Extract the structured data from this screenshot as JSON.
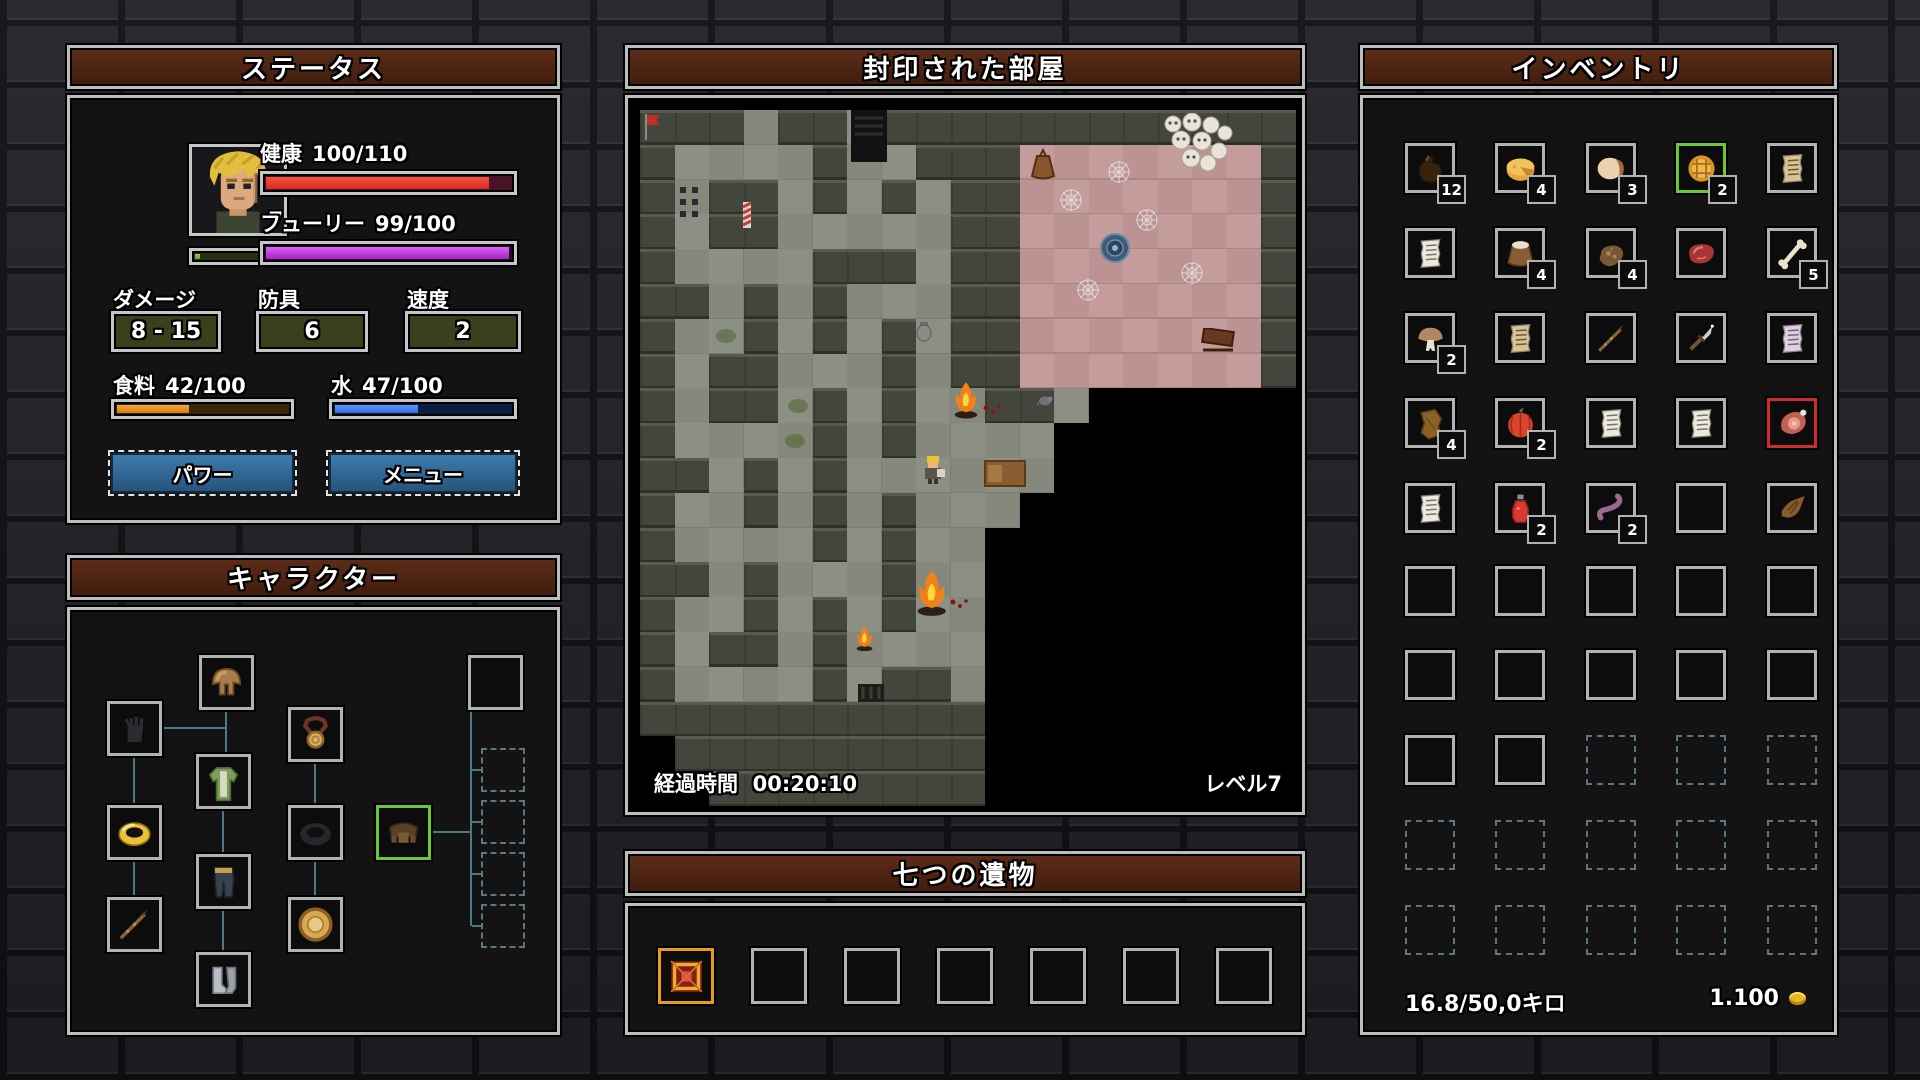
{
  "status_panel": {
    "title": "ステータス",
    "level": "7",
    "health": {
      "label": "健康",
      "value": "100/110",
      "pct": 91
    },
    "fury": {
      "label": "フューリー",
      "value": "99/100",
      "pct": 99
    },
    "xp_pct": 6,
    "damage": {
      "label": "ダメージ",
      "value": "8 - 15"
    },
    "armor": {
      "label": "防具",
      "value": "6"
    },
    "speed": {
      "label": "速度",
      "value": "2"
    },
    "food": {
      "label": "食料",
      "value": "42/100",
      "pct": 42
    },
    "water": {
      "label": "水",
      "value": "47/100",
      "pct": 47
    },
    "buttons": {
      "power": "パワー",
      "menu": "メニュー"
    }
  },
  "character_panel": {
    "title": "キャラクター",
    "slots": [
      {
        "icon": "hood",
        "x": 129,
        "y": 45
      },
      {
        "icon": "glove-empty",
        "x": 37,
        "y": 91
      },
      {
        "icon": "amulet",
        "x": 218,
        "y": 97
      },
      {
        "icon": "tunic",
        "x": 126,
        "y": 144
      },
      {
        "icon": "ring-gold",
        "x": 37,
        "y": 195
      },
      {
        "icon": "ring-empty",
        "x": 218,
        "y": 195
      },
      {
        "icon": "belt",
        "x": 306,
        "y": 195,
        "highlight": "green"
      },
      {
        "icon": "pants",
        "x": 126,
        "y": 244
      },
      {
        "icon": "spear",
        "x": 37,
        "y": 287
      },
      {
        "icon": "buckler",
        "x": 218,
        "y": 287
      },
      {
        "icon": "boots",
        "x": 126,
        "y": 342
      },
      {
        "icon": null,
        "x": 398,
        "y": 45
      },
      {
        "icon": null,
        "x": 411,
        "y": 138,
        "locked": true
      },
      {
        "icon": null,
        "x": 411,
        "y": 190,
        "locked": true
      },
      {
        "icon": null,
        "x": 411,
        "y": 242,
        "locked": true
      },
      {
        "icon": null,
        "x": 411,
        "y": 294,
        "locked": true
      }
    ],
    "lines": [
      {
        "x": 155,
        "y": 100,
        "w": 2,
        "h": 44
      },
      {
        "x": 92,
        "y": 117,
        "w": 63,
        "h": 2
      },
      {
        "x": 63,
        "y": 146,
        "w": 2,
        "h": 49
      },
      {
        "x": 63,
        "y": 250,
        "w": 2,
        "h": 37
      },
      {
        "x": 244,
        "y": 152,
        "w": 2,
        "h": 43
      },
      {
        "x": 244,
        "y": 250,
        "w": 2,
        "h": 37
      },
      {
        "x": 152,
        "y": 199,
        "w": 2,
        "h": 45
      },
      {
        "x": 152,
        "y": 299,
        "w": 2,
        "h": 43
      },
      {
        "x": 361,
        "y": 221,
        "w": 41,
        "h": 2
      },
      {
        "x": 400,
        "y": 100,
        "w": 2,
        "h": 216
      },
      {
        "x": 402,
        "y": 159,
        "w": 11,
        "h": 2
      },
      {
        "x": 402,
        "y": 211,
        "w": 11,
        "h": 2
      },
      {
        "x": 402,
        "y": 263,
        "w": 11,
        "h": 2
      },
      {
        "x": 402,
        "y": 315,
        "w": 11,
        "h": 2
      }
    ]
  },
  "map_panel": {
    "title": "封印された部屋",
    "elapsed_label": "経過時間",
    "elapsed_time": "00:20:10",
    "level_label": "レベル7",
    "legend": {
      "#": "wall",
      ".": "floor",
      "p": "wood",
      " ": "dark"
    },
    "tiles": [
      "###.##.############",
      "#....#..###ppppppp#",
      "#.##.#.#.##ppppppp#",
      "#.##.....##ppppppp#",
      "#....###.##ppppppp#",
      "##.#.#...##ppppppp#",
      "#..#.#.#.##ppppppp#",
      "#.##...#.##ppppppp#",
      "#.##.#.#..##.      ",
      "#....#.#....       ",
      "##.#.#......       ",
      "#..#.#.#...        ",
      "#....#.#..         ",
      "##.#...#..         ",
      "#..#.#.#..         ",
      "#.##.#....         ",
      "#....#.##.         ",
      "##########         ",
      " #########         ",
      "  ########         "
    ],
    "sprites": [
      {
        "type": "flag",
        "x": 0.1,
        "y": 0.05
      },
      {
        "type": "stairs",
        "x": 6.1,
        "y": 0.0
      },
      {
        "type": "dots",
        "x": 1.1,
        "y": 2.15
      },
      {
        "type": "pole",
        "x": 2.9,
        "y": 2.6
      },
      {
        "type": "urn",
        "x": 8.0,
        "y": 6.1
      },
      {
        "type": "sack",
        "x": 11.25,
        "y": 1.1
      },
      {
        "type": "skulls",
        "x": 15.1,
        "y": 0.1
      },
      {
        "type": "web",
        "x": 12.1,
        "y": 2.2
      },
      {
        "type": "web",
        "x": 14.3,
        "y": 2.8
      },
      {
        "type": "web",
        "x": 15.6,
        "y": 4.3
      },
      {
        "type": "web",
        "x": 12.6,
        "y": 4.8
      },
      {
        "type": "web",
        "x": 13.5,
        "y": 1.4
      },
      {
        "type": "emblem",
        "x": 13.3,
        "y": 3.5
      },
      {
        "type": "sled",
        "x": 16.2,
        "y": 6.25
      },
      {
        "type": "fire",
        "x": 9.0,
        "y": 7.8,
        "s": 1.0
      },
      {
        "type": "rat",
        "x": 11.5,
        "y": 8.1
      },
      {
        "type": "blood",
        "x": 9.9,
        "y": 8.35
      },
      {
        "type": "hero",
        "x": 8.1,
        "y": 9.9
      },
      {
        "type": "bed",
        "x": 9.95,
        "y": 10.05
      },
      {
        "type": "fire",
        "x": 7.9,
        "y": 13.2,
        "s": 1.25
      },
      {
        "type": "blood",
        "x": 8.95,
        "y": 13.95
      },
      {
        "type": "fire",
        "x": 6.2,
        "y": 14.8,
        "s": 0.7
      },
      {
        "type": "moss",
        "x": 2.2,
        "y": 6.3
      },
      {
        "type": "moss",
        "x": 4.3,
        "y": 8.3
      },
      {
        "type": "moss",
        "x": 4.2,
        "y": 9.3
      },
      {
        "type": "grate",
        "x": 6.3,
        "y": 16.5
      }
    ]
  },
  "relics_panel": {
    "title": "七つの遺物",
    "slots": [
      {
        "icon": "relic",
        "highlight": "orange"
      },
      {},
      {},
      {},
      {},
      {},
      {}
    ]
  },
  "inventory_panel": {
    "title": "インベントリ",
    "weight": "16.8/50,0キロ",
    "gold": "1.100",
    "grid": [
      [
        {
          "icon": "waterskin",
          "count": "12"
        },
        {
          "icon": "cheese",
          "count": "4"
        },
        {
          "icon": "bread",
          "count": "3"
        },
        {
          "icon": "pie",
          "count": "2",
          "highlight": "green"
        },
        {
          "icon": "scroll-tan"
        }
      ],
      [
        {
          "icon": "scroll-white"
        },
        {
          "icon": "sack",
          "count": "4"
        },
        {
          "icon": "driedmeat",
          "count": "4"
        },
        {
          "icon": "steak"
        },
        {
          "icon": "bone",
          "count": "5"
        }
      ],
      [
        {
          "icon": "mushroom",
          "count": "2"
        },
        {
          "icon": "scroll-tan"
        },
        {
          "icon": "spear"
        },
        {
          "icon": "dagger"
        },
        {
          "icon": "scroll-lavender"
        }
      ],
      [
        {
          "icon": "leather",
          "count": "4"
        },
        {
          "icon": "pumpkin",
          "count": "2"
        },
        {
          "icon": "scroll-white"
        },
        {
          "icon": "scroll-white"
        },
        {
          "icon": "ham",
          "highlight": "red"
        }
      ],
      [
        {
          "icon": "scroll-white"
        },
        {
          "icon": "potion",
          "count": "2"
        },
        {
          "icon": "worm",
          "count": "2"
        },
        {},
        {
          "icon": "paw"
        }
      ],
      [
        {},
        {},
        {},
        {},
        {}
      ],
      [
        {},
        {},
        {},
        {},
        {}
      ],
      [
        {},
        {},
        {
          "locked": true
        },
        {
          "locked": true
        },
        {
          "locked": true
        }
      ],
      [
        {
          "locked": true
        },
        {
          "locked": true
        },
        {
          "locked": true
        },
        {
          "locked": true
        },
        {
          "locked": true
        }
      ],
      [
        {
          "locked": true
        },
        {
          "locked": true
        },
        {
          "locked": true
        },
        {
          "locked": true
        },
        {
          "locked": true
        }
      ]
    ]
  },
  "colors": {
    "health": "#e83a28",
    "fury": "#bc2ee0",
    "food": "#e8881c",
    "water": "#2f6fe8",
    "xp": "#7ac820",
    "highlight_green": "#6cc832",
    "highlight_red": "#d02c2c",
    "highlight_orange": "#e89c1c",
    "header_brown": "#5e2d18",
    "button_blue": "#2f6591"
  }
}
